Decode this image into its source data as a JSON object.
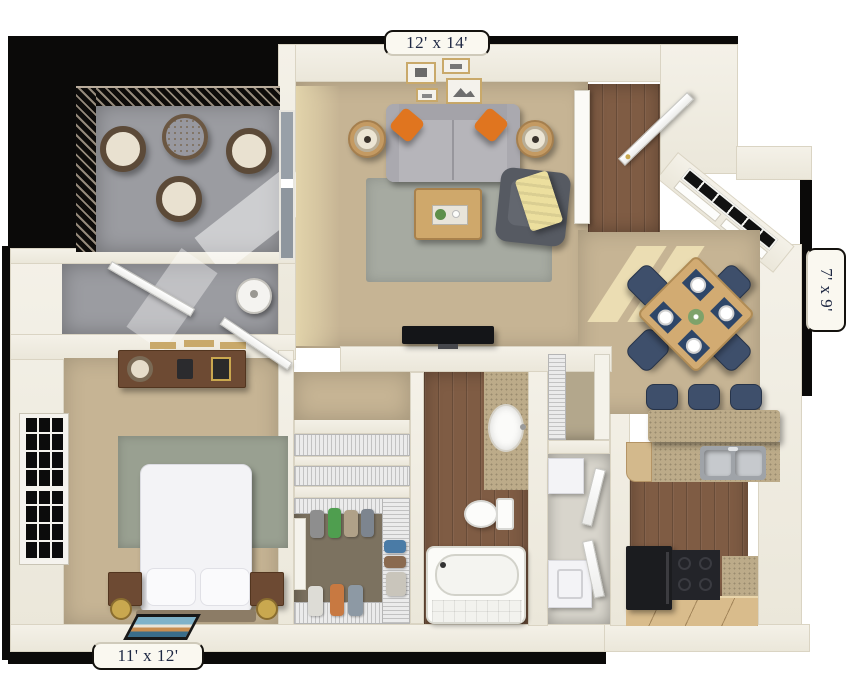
{
  "labels": {
    "living_room": "12' x 14'",
    "dining_nook": "7' x 9'",
    "bedroom": "11' x 12'"
  },
  "colors": {
    "outline_black": "#0b0a09",
    "wall_cream": "#f1eee4",
    "carpet_tan": "#c6b494",
    "wood_floor": "#7f5c44",
    "patio_concrete": "#9b9ca1",
    "living_rug_gray": "#a6aaa1",
    "bedroom_rug_sage": "#99a091",
    "sofa_gray": "#b6b5ba",
    "pillow_orange": "#e0751f",
    "chair_navy": "#3e4f6b",
    "counter_granite": "#bcab89",
    "cabinet_tan": "#d9bc8c",
    "appliance_black": "#1d1e21",
    "throw_yellow": "#ecdf9e",
    "label_ink": "#1d2742",
    "tab_bg": "#faf8f0"
  }
}
